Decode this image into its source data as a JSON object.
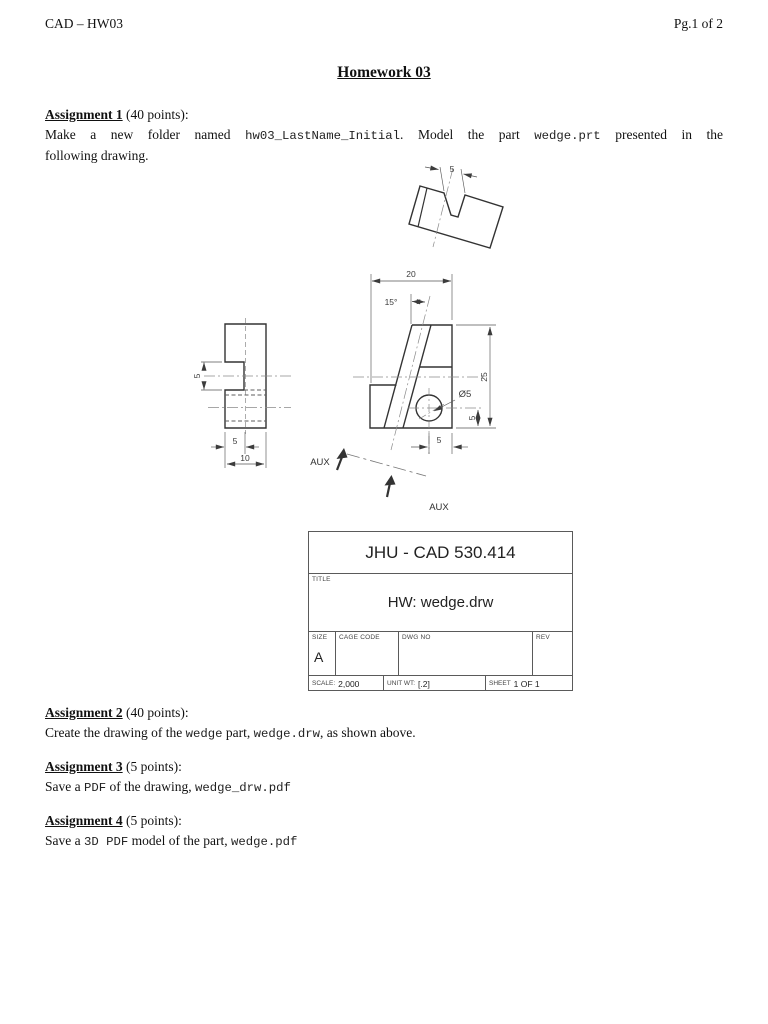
{
  "header": {
    "left": "CAD – HW03",
    "right": "Pg.1 of 2"
  },
  "title": "Homework 03",
  "assignments": {
    "a1": {
      "heading": "Assignment 1",
      "points": " (40 points):",
      "p1": "Make a new folder named ",
      "code1": "hw03_LastName_Initial",
      "p2": ". Model the part ",
      "code2": "wedge.prt",
      "p3": " presented in the",
      "line2": "following drawing."
    },
    "a2": {
      "heading": "Assignment 2",
      "points": " (40 points):",
      "p1": "Create the drawing of the ",
      "code1": "wedge",
      "p2": " part, ",
      "code2": "wedge.drw",
      "p3": ", as shown above."
    },
    "a3": {
      "heading": "Assignment 3",
      "points": " (5 points):",
      "p1": "Save a ",
      "code1": "PDF",
      "p2": " of the drawing, ",
      "code2": "wedge_drw.pdf",
      "p3": ""
    },
    "a4": {
      "heading": "Assignment 4",
      "points": " (5 points):",
      "p1": "Save a ",
      "code1": "3D PDF",
      "p2": " model of the part, ",
      "code2": "wedge.pdf",
      "p3": ""
    }
  },
  "drawing": {
    "dims": {
      "aux_slot_width": "5",
      "front_width": "20",
      "angle": "15°",
      "front_height": "25",
      "hole_dia": "Ø5",
      "hole_cy_offset": "5",
      "hole_cx_offset": "5",
      "side_notch_h": "5",
      "side_notch_d": "5",
      "side_depth": "10",
      "aux_label": "AUX"
    }
  },
  "title_block": {
    "company": "JHU - CAD 530.414",
    "title_label": "TITLE",
    "title_value": "HW: wedge.drw",
    "size_label": "SIZE",
    "size_value": "A",
    "cage_label": "CAGE CODE",
    "dwg_label": "DWG NO",
    "rev_label": "REV",
    "scale_label": "SCALE:",
    "scale_value": "2,000",
    "unit_wt_label": "UNIT WT:",
    "unit_wt_value": "[.2]",
    "sheet_label": "SHEET",
    "sheet_value": "1 OF 1"
  }
}
